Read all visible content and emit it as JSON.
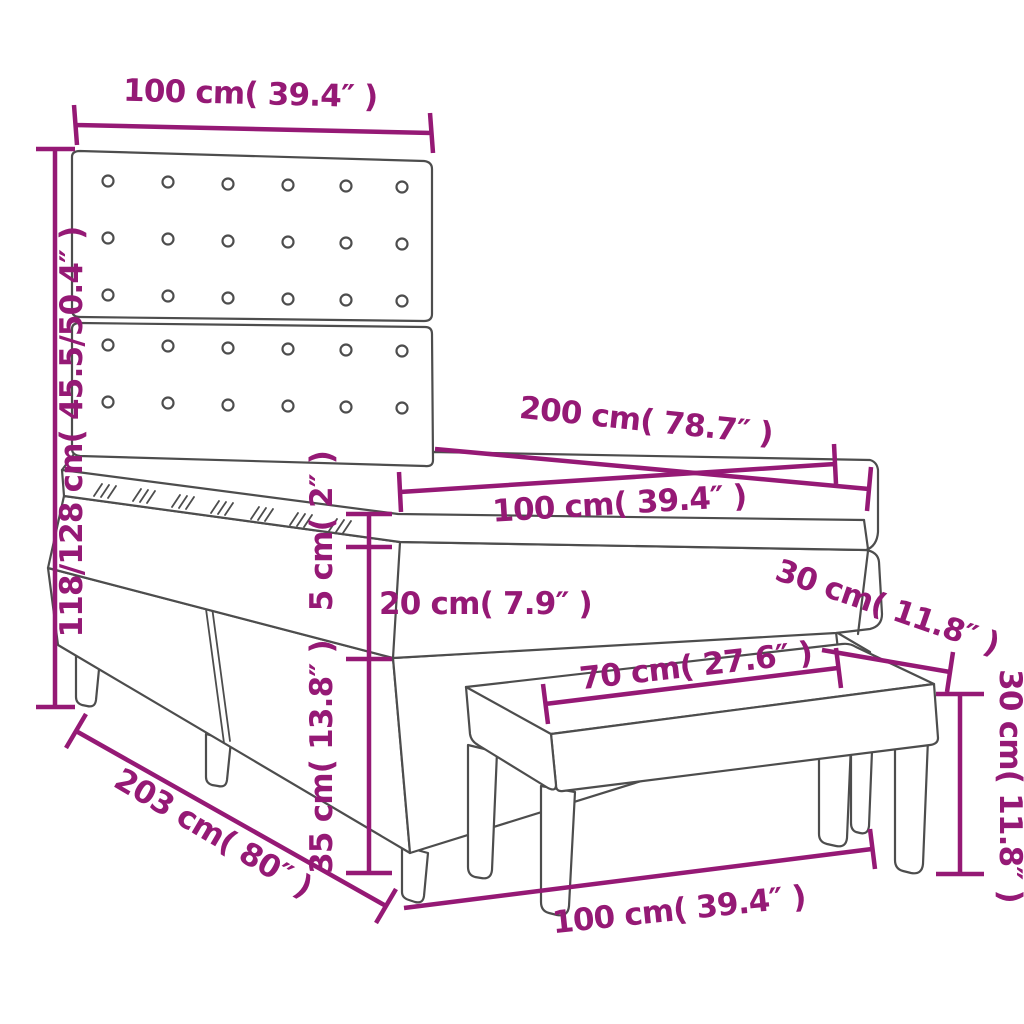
{
  "colors": {
    "accent": "#951975",
    "line": "#4d4d4d",
    "background": "#ffffff"
  },
  "diagram": {
    "subject": "box-spring-bed-with-headboard-topper-and-bench",
    "button_grid": {
      "columns": 6,
      "rows": 5
    }
  },
  "measurements": [
    {
      "id": "headboard-width",
      "cm": "100",
      "inches": "39.4",
      "text": "100 cm( 39.4″ )"
    },
    {
      "id": "overall-height",
      "cm": "118/128",
      "inches": "45.5/50.4",
      "text": "118/128 cm( 45.5/50.4″ )"
    },
    {
      "id": "bed-length",
      "cm": "200",
      "inches": "78.7",
      "text": "200 cm( 78.7″ )"
    },
    {
      "id": "bed-surface-width",
      "cm": "100",
      "inches": "39.4",
      "text": "100 cm( 39.4″ )"
    },
    {
      "id": "topper-thickness",
      "cm": "5",
      "inches": "2",
      "text": "5 cm( 2″ )"
    },
    {
      "id": "mattress-thickness",
      "cm": "20",
      "inches": "7.9",
      "text": "20 cm( 7.9″ )"
    },
    {
      "id": "bench-depth",
      "cm": "30",
      "inches": "11.8",
      "text": "30 cm( 11.8″ )"
    },
    {
      "id": "bench-seat-width",
      "cm": "70",
      "inches": "27.6",
      "text": "70 cm( 27.6″ )"
    },
    {
      "id": "bench-height",
      "cm": "30",
      "inches": "11.8",
      "text": "30 cm( 11.8″ )"
    },
    {
      "id": "base-height",
      "cm": "35",
      "inches": "13.8",
      "text": "35 cm( 13.8″ )"
    },
    {
      "id": "total-length",
      "cm": "203",
      "inches": "80",
      "text": "203 cm( 80″ )"
    },
    {
      "id": "bench-total-width",
      "cm": "100",
      "inches": "39.4",
      "text": "100 cm( 39.4″ )"
    }
  ]
}
